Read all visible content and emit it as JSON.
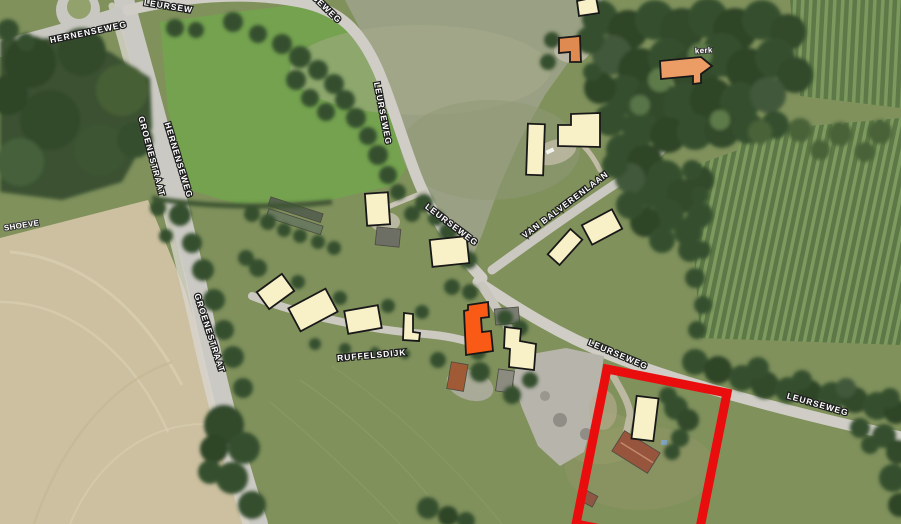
{
  "map": {
    "colors": {
      "standard": "#F8F1C8",
      "highlight": "#F95B16",
      "church": "#EC9D65",
      "accent": "#DE8A50",
      "building_stroke": "#181818",
      "parcel_red": "#E90D0D",
      "label_fill": "#FFFFFF",
      "label_halo": "#1E1E1E"
    },
    "road_labels": [
      {
        "id": "leurseweg-top-fragment",
        "text": "LEURSEW",
        "x": 168,
        "y": 9,
        "rot": 9
      },
      {
        "id": "leurseweg-top-fragment-2",
        "text": "SEWEG",
        "x": 325,
        "y": 11,
        "rot": 44
      },
      {
        "id": "hernenseweg-horizontal",
        "text": "HERNENSEWEG",
        "x": 89,
        "y": 35,
        "rot": -12
      },
      {
        "id": "groenestraat-upper",
        "text": "GROENESTRAAT",
        "x": 149,
        "y": 157,
        "rot": 75
      },
      {
        "id": "hernenseweg-vertical",
        "text": "HERNENSEWEG",
        "x": 176,
        "y": 161,
        "rot": 73
      },
      {
        "id": "groenestraat-lower",
        "text": "GROENESTRAAT",
        "x": 207,
        "y": 334,
        "rot": 72
      },
      {
        "id": "leurseweg-north",
        "text": "LEURSEWEG",
        "x": 380,
        "y": 114,
        "rot": 79
      },
      {
        "id": "leurseweg-centre",
        "text": "LEURSEWEG",
        "x": 450,
        "y": 227,
        "rot": 37
      },
      {
        "id": "van-balverenlaan",
        "text": "VAN BALVERENLAAN",
        "x": 567,
        "y": 207,
        "rot": -37
      },
      {
        "id": "ruffelsdijk",
        "text": "RUFFELSDIJK",
        "x": 372,
        "y": 358,
        "rot": -5
      },
      {
        "id": "leurseweg-east",
        "text": "LEURSEWEG",
        "x": 617,
        "y": 357,
        "rot": 23
      },
      {
        "id": "leurseweg-far-east",
        "text": "LEURSEWEG",
        "x": 817,
        "y": 407,
        "rot": 16
      }
    ],
    "poi_labels": [
      {
        "id": "church-label",
        "text": "kerk",
        "x": 704,
        "y": 53,
        "rot": -4
      },
      {
        "id": "farm-label",
        "text": "SHOEVE",
        "x": 22,
        "y": 228,
        "rot": -9
      }
    ],
    "buildings": [
      {
        "id": "north-edge-house",
        "kind": "standard",
        "points": "577,1 596,-3 599,13 579,16"
      },
      {
        "id": "north-accent-house",
        "kind": "accent",
        "points": "559,38 580,36 581,62 570,62 570,52 559,53"
      },
      {
        "id": "church",
        "kind": "church",
        "points": "660,61 701,57 712,66 701,74 701,83 693,84 693,76 661,79"
      },
      {
        "id": "balverenlaan-house-west",
        "kind": "standard",
        "x": 527,
        "y": 124,
        "w": 17,
        "h": 51,
        "rot": 2
      },
      {
        "id": "balverenlaan-house-north",
        "kind": "standard",
        "points": "571,114 600,113 600,147 558,146 558,125 571,125"
      },
      {
        "id": "balverenlaan-barn-small",
        "kind": "standard",
        "x": 548,
        "y": 239,
        "w": 34,
        "h": 16,
        "rot": -48
      },
      {
        "id": "balverenlaan-barn-large",
        "kind": "standard",
        "x": 585,
        "y": 216,
        "w": 34,
        "h": 22,
        "rot": -28
      },
      {
        "id": "leurseweg-house-north",
        "kind": "standard",
        "x": 366,
        "y": 193,
        "w": 23,
        "h": 32,
        "rot": -4
      },
      {
        "id": "crossroads-house",
        "kind": "standard",
        "x": 431,
        "y": 238,
        "w": 37,
        "h": 27,
        "rot": -6
      },
      {
        "id": "ruffelsdijk-house-1",
        "kind": "standard",
        "x": 260,
        "y": 281,
        "w": 31,
        "h": 21,
        "rot": -36
      },
      {
        "id": "ruffelsdijk-house-2",
        "kind": "standard",
        "x": 292,
        "y": 297,
        "w": 42,
        "h": 26,
        "rot": -28
      },
      {
        "id": "ruffelsdijk-house-3",
        "kind": "standard",
        "x": 346,
        "y": 308,
        "w": 34,
        "h": 23,
        "rot": -10
      },
      {
        "id": "ruffelsdijk-house-4",
        "kind": "standard",
        "points": "404,313 413,314 413,332 420,333 419,341 403,340"
      },
      {
        "id": "highlight-building",
        "kind": "highlight",
        "points": "468,305 488,302 489,317 481,318 482,332 491,331 493,351 466,355 464,311 468,310"
      },
      {
        "id": "parking-house-east",
        "kind": "standard",
        "points": "505,327 521,329 520,341 536,344 534,370 509,367 510,349 504,348"
      },
      {
        "id": "parcel-house",
        "kind": "standard",
        "x": 634,
        "y": 397,
        "w": 22,
        "h": 43,
        "rot": 7
      }
    ],
    "parcel": {
      "id": "selected-parcel",
      "points": "607,369 727,393 696,548 576,524",
      "stroke_width": 9
    }
  }
}
